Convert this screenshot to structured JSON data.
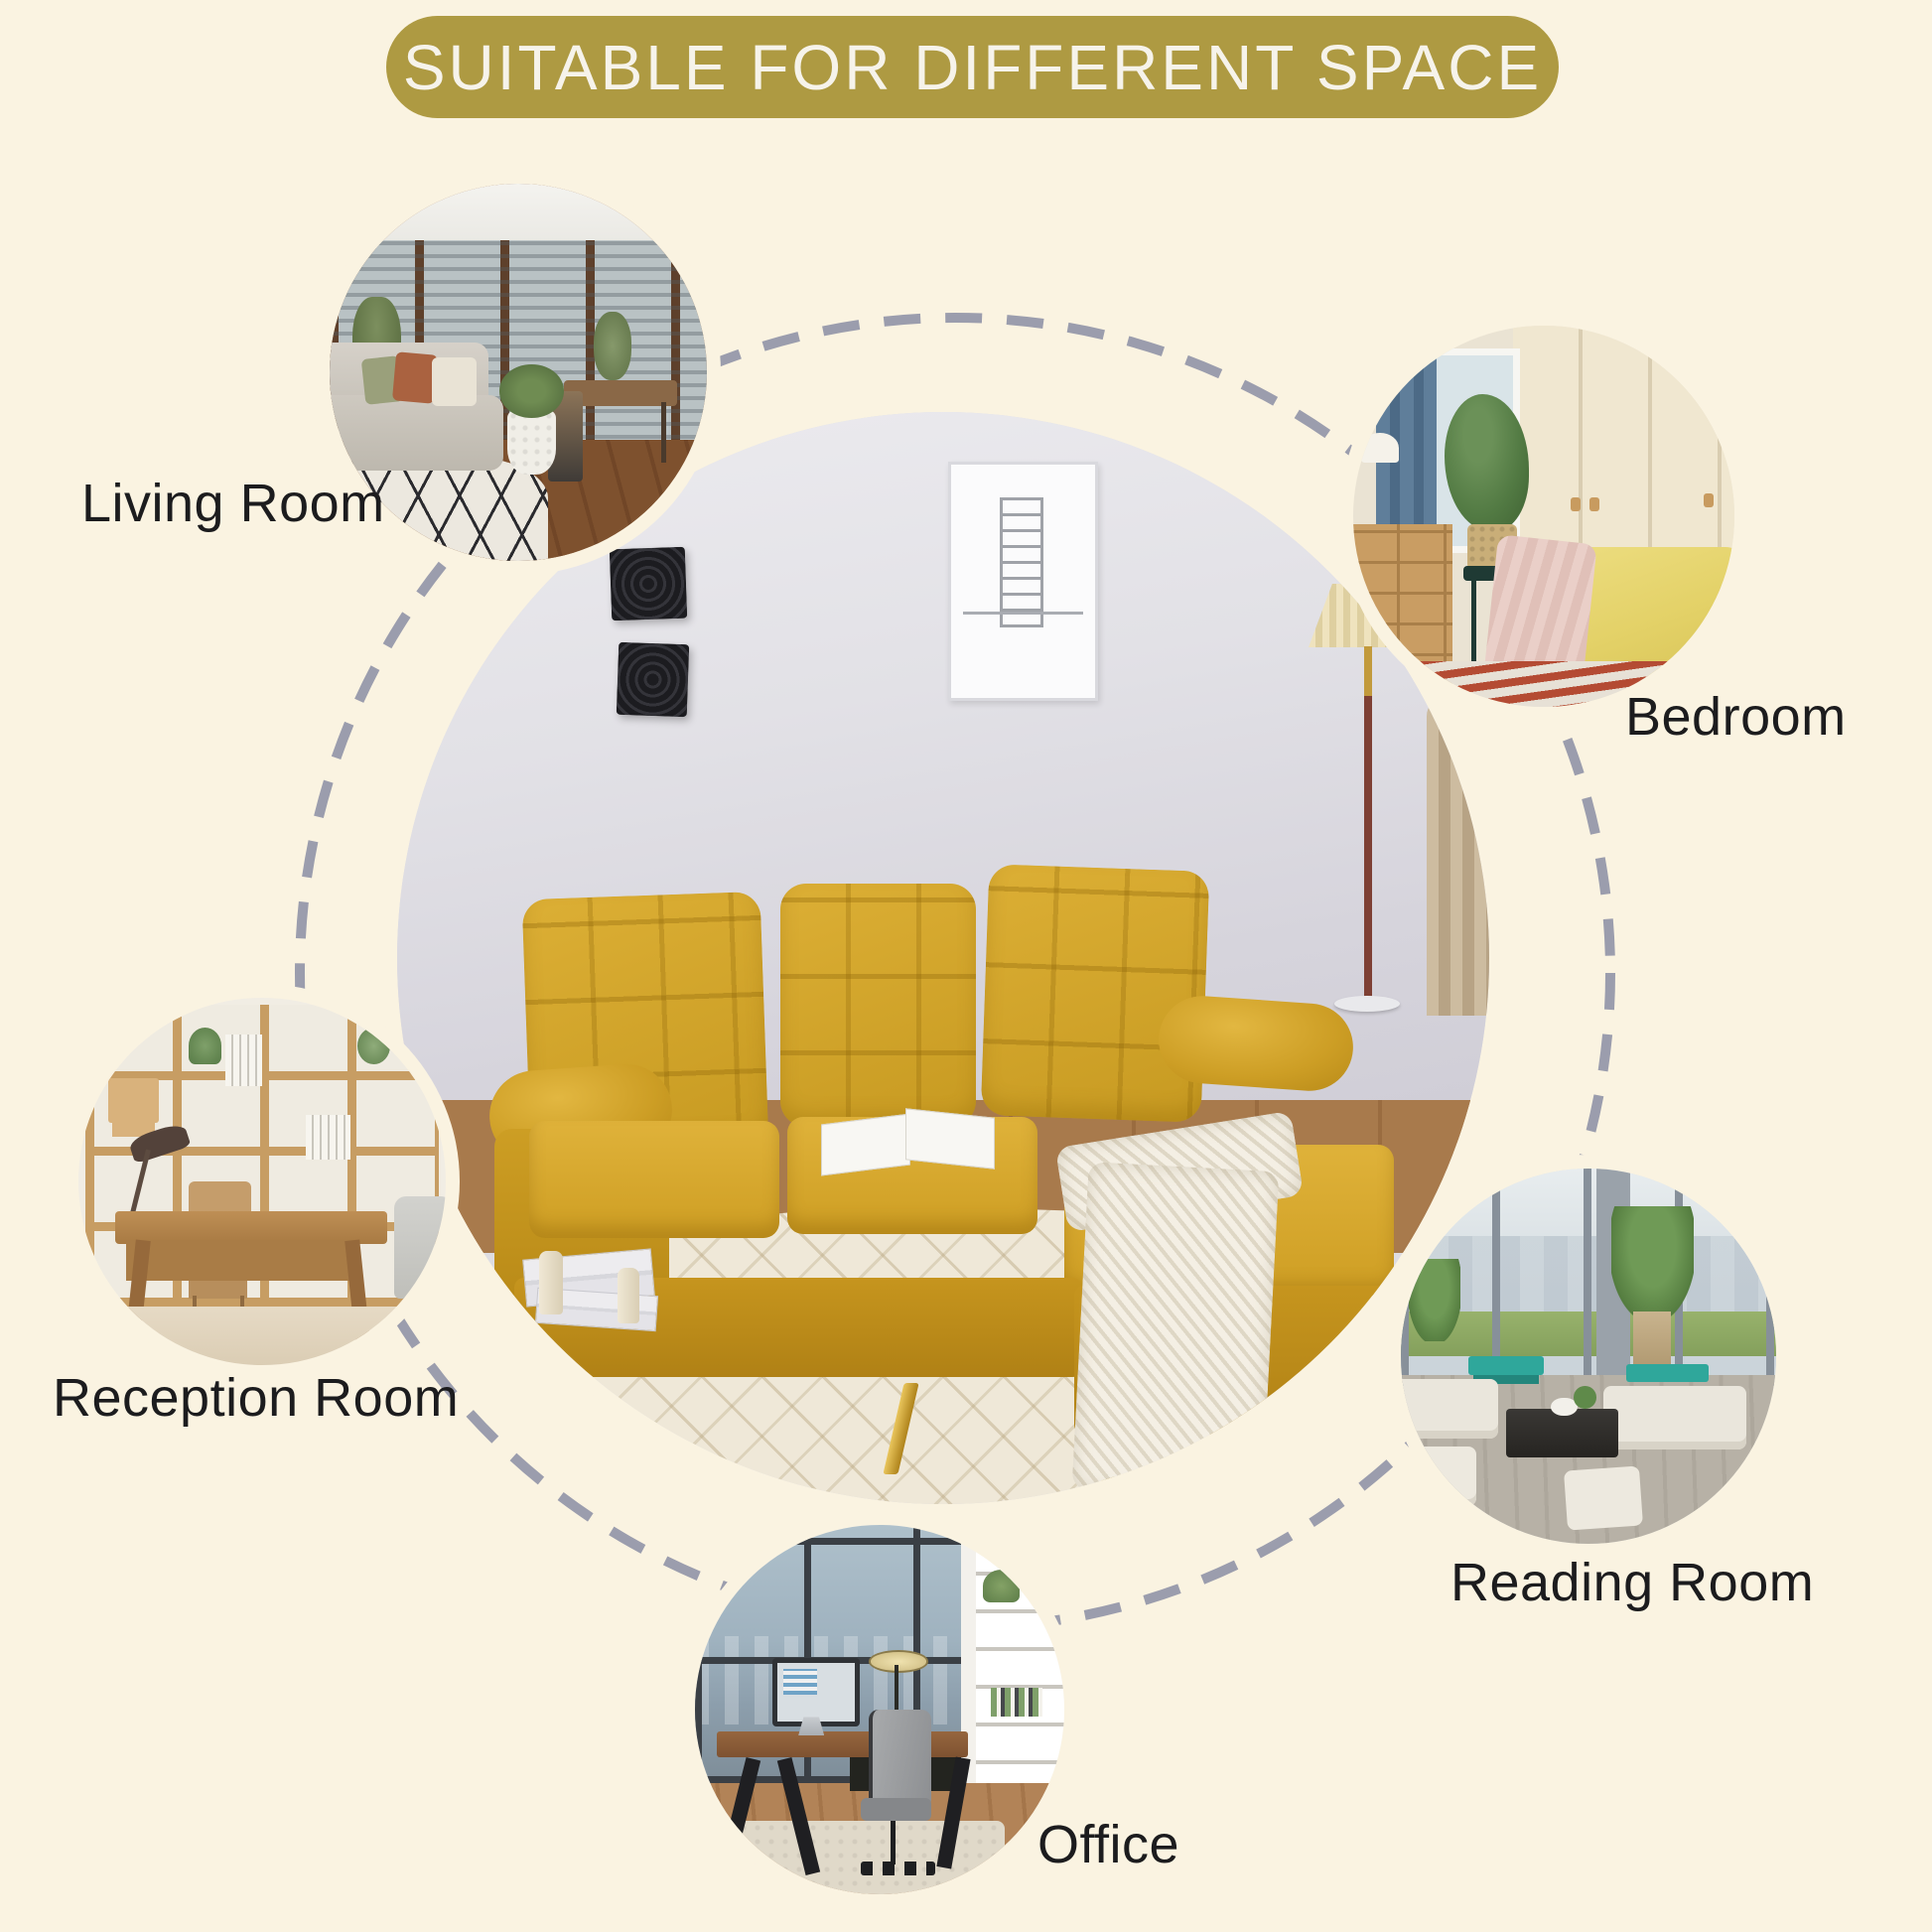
{
  "banner": {
    "label": "SUITABLE FOR DIFFERENT SPACE"
  },
  "rooms": [
    {
      "id": "living-room",
      "label": "Living Room"
    },
    {
      "id": "bedroom",
      "label": "Bedroom"
    },
    {
      "id": "reception-room",
      "label": "Reception Room"
    },
    {
      "id": "reading-room",
      "label": "Reading Room"
    },
    {
      "id": "office",
      "label": "Office"
    }
  ],
  "colors": {
    "background": "#FAF3E1",
    "banner_bg": "#AE9A42",
    "banner_text": "#F6F3EA",
    "label_text": "#1C1C1E",
    "dash": "#9B9DAD",
    "sofa_yellow": "#D3A52A",
    "sofa_legs_gold": "#C9A227",
    "wall_gray": "#DEDDE2",
    "rug_cream": "#EFE8D8"
  }
}
